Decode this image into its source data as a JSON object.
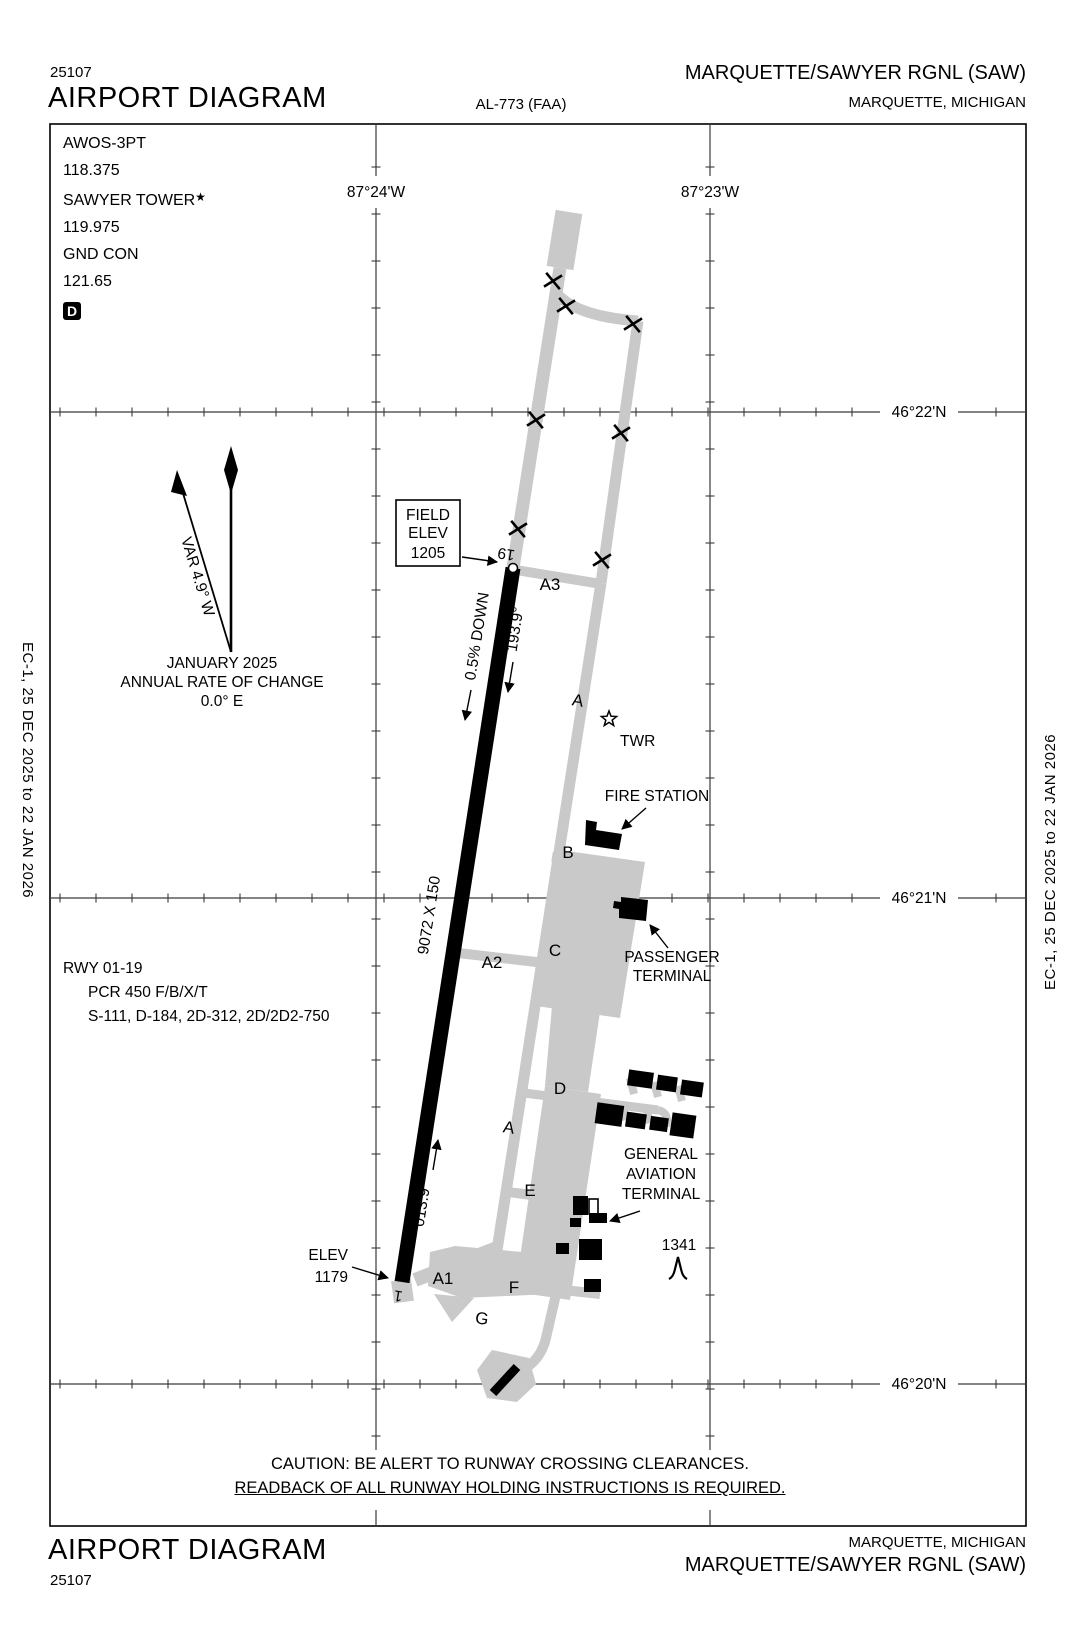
{
  "header": {
    "code": "25107",
    "title": "AIRPORT DIAGRAM",
    "procedure_id": "AL-773 (FAA)",
    "airport_name": "MARQUETTE/SAWYER RGNL (SAW)",
    "city": "MARQUETTE, MICHIGAN"
  },
  "footer": {
    "title": "AIRPORT DIAGRAM",
    "code": "25107",
    "city": "MARQUETTE, MICHIGAN",
    "airport_name": "MARQUETTE/SAWYER RGNL (SAW)"
  },
  "edge_note": "EC-1,  25 DEC 2025  to  22 JAN 2026",
  "comms": {
    "awos_label": "AWOS-3PT",
    "awos_freq": "118.375",
    "tower_label": "SAWYER TOWER",
    "tower_star": "★",
    "tower_freq": "119.975",
    "ground_label": "GND CON",
    "ground_freq": "121.65",
    "d_symbol": "D"
  },
  "compass": {
    "variation": "VAR 4.9° W",
    "date": "JANUARY 2025",
    "rate_label": "ANNUAL RATE OF CHANGE",
    "rate_value": "0.0° E"
  },
  "graticule": {
    "lat_labels": [
      "46°22'N",
      "46°21'N",
      "46°20'N"
    ],
    "lon_labels": [
      "87°24'W",
      "87°23'W"
    ]
  },
  "runway_data": {
    "designation": "RWY 01-19",
    "pcr": "PCR 450 F/B/X/T",
    "strength": "S-111, D-184, 2D-312, 2D/2D2-750"
  },
  "field_elev": {
    "line1": "FIELD",
    "line2": "ELEV",
    "line3": "1205"
  },
  "rwy01_elev": {
    "line1": "ELEV",
    "line2": "1179"
  },
  "runway": {
    "dimensions": "9072 X 150",
    "slope": "0.5% DOWN",
    "hdg_19": "193.9°",
    "hdg_01": "013.9°",
    "end_19": "19",
    "end_01": "1"
  },
  "taxiways": {
    "a": "A",
    "a1": "A1",
    "a2": "A2",
    "a3": "A3",
    "b": "B",
    "c": "C",
    "d": "D",
    "e": "E",
    "f": "F",
    "g": "G"
  },
  "features": {
    "tower": "TWR",
    "fire_station": "FIRE STATION",
    "passenger_terminal": [
      "PASSENGER",
      "TERMINAL"
    ],
    "ga_terminal": [
      "GENERAL",
      "AVIATION",
      "TERMINAL"
    ],
    "obstacle_elev": "1341"
  },
  "caution": {
    "line1": "CAUTION: BE ALERT TO RUNWAY CROSSING CLEARANCES.",
    "line2": "READBACK OF ALL RUNWAY HOLDING INSTRUCTIONS IS REQUIRED."
  },
  "colors": {
    "pavement_gray": "#c9c9c9",
    "building_black": "#000000"
  }
}
